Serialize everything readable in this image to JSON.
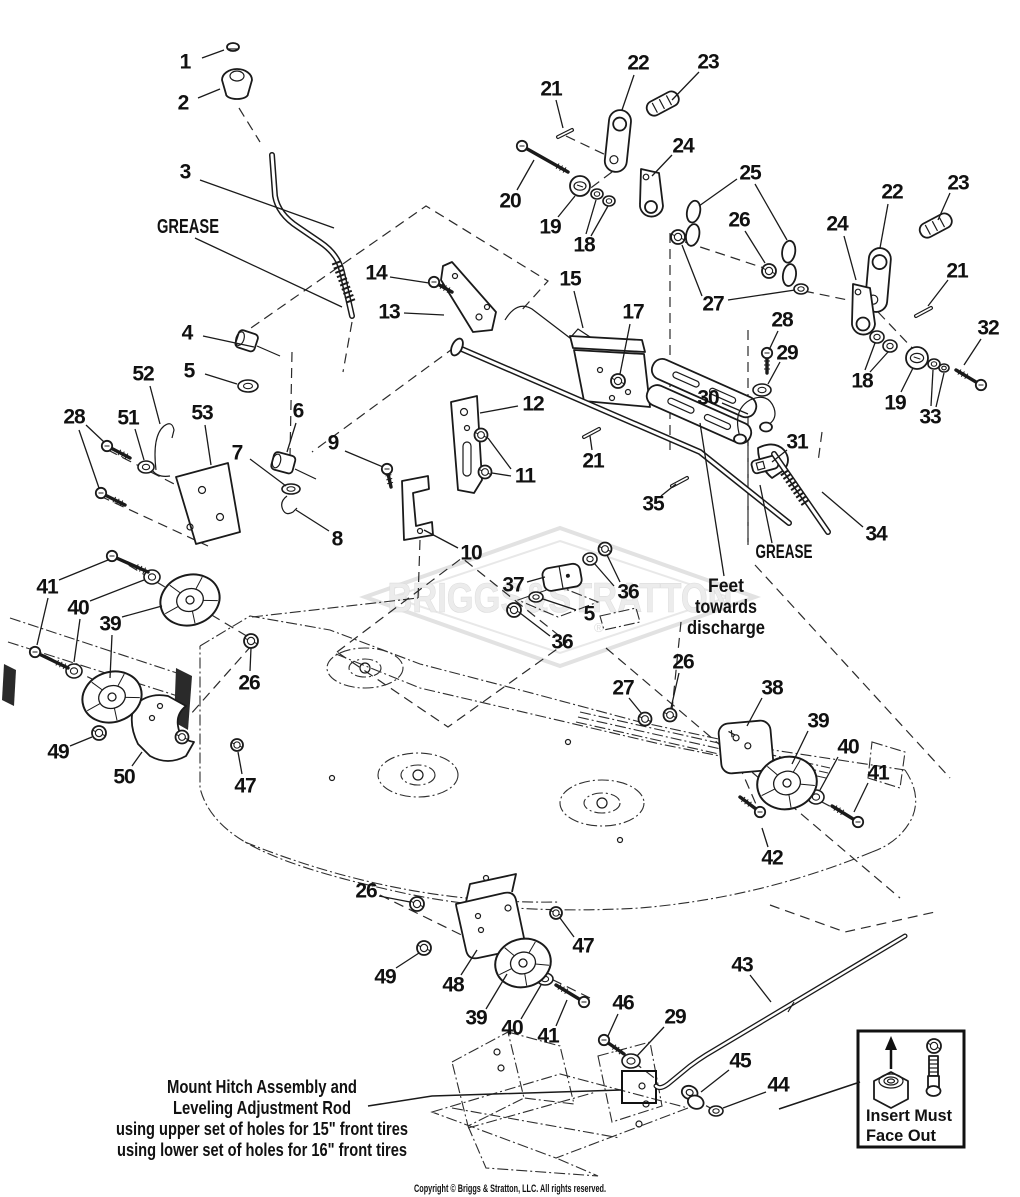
{
  "diagram": {
    "watermark": {
      "text": "BRIGGS&STRATTON",
      "registered_mark": "®"
    },
    "labels": {
      "grease_left": "GREASE",
      "grease_right": "GREASE",
      "feet_line1": "Feet",
      "feet_line2": "towards",
      "feet_line3": "discharge",
      "mount_line1": "Mount Hitch Assembly and",
      "mount_line2": "Leveling Adjustment Rod",
      "mount_line3": "using upper set of holes for 15\" front tires",
      "mount_line4": "using lower set of holes for 16\" front tires",
      "insert_line1": "Insert Must",
      "insert_line2": "Face Out"
    },
    "copyright": "Copyright © Briggs & Stratton, LLC. All rights reserved.",
    "callouts": [
      {
        "label": "1",
        "x": 185,
        "y": 62,
        "leaders": [
          [
            202,
            58,
            224,
            50
          ]
        ]
      },
      {
        "label": "2",
        "x": 183,
        "y": 103,
        "leaders": [
          [
            198,
            98,
            220,
            89
          ]
        ]
      },
      {
        "label": "3",
        "x": 185,
        "y": 172,
        "leaders": [
          [
            200,
            180,
            334,
            228
          ]
        ]
      },
      {
        "label": "4",
        "x": 187,
        "y": 333,
        "leaders": [
          [
            203,
            336,
            254,
            347
          ]
        ]
      },
      {
        "label": "5",
        "x": 189,
        "y": 371,
        "leaders": [
          [
            205,
            374,
            237,
            384
          ]
        ]
      },
      {
        "label": "52",
        "x": 143,
        "y": 374,
        "leaders": [
          [
            150,
            386,
            160,
            424
          ]
        ]
      },
      {
        "label": "51",
        "x": 128,
        "y": 418,
        "leaders": [
          [
            135,
            429,
            144,
            460
          ]
        ]
      },
      {
        "label": "53",
        "x": 202,
        "y": 413,
        "leaders": [
          [
            205,
            425,
            211,
            465
          ]
        ]
      },
      {
        "label": "28",
        "x": 74,
        "y": 417,
        "leaders": [
          [
            86,
            425,
            104,
            442
          ],
          [
            79,
            430,
            99,
            488
          ]
        ]
      },
      {
        "label": "6",
        "x": 298,
        "y": 411,
        "leaders": [
          [
            296,
            423,
            287,
            452
          ]
        ]
      },
      {
        "label": "7",
        "x": 237,
        "y": 453,
        "leaders": [
          [
            250,
            459,
            286,
            486
          ]
        ]
      },
      {
        "label": "8",
        "x": 337,
        "y": 539,
        "leaders": [
          [
            329,
            531,
            296,
            510
          ]
        ]
      },
      {
        "label": "9",
        "x": 333,
        "y": 443,
        "leaders": [
          [
            345,
            451,
            383,
            467
          ]
        ]
      },
      {
        "label": "10",
        "x": 471,
        "y": 553,
        "leaders": [
          [
            458,
            548,
            424,
            530
          ]
        ]
      },
      {
        "label": "14",
        "x": 376,
        "y": 273,
        "leaders": [
          [
            390,
            277,
            429,
            283
          ]
        ]
      },
      {
        "label": "13",
        "x": 389,
        "y": 312,
        "leaders": [
          [
            404,
            313,
            444,
            315
          ]
        ]
      },
      {
        "label": "15",
        "x": 570,
        "y": 279,
        "leaders": [
          [
            574,
            291,
            583,
            328
          ]
        ]
      },
      {
        "label": "17",
        "x": 633,
        "y": 312,
        "leaders": [
          [
            630,
            324,
            620,
            374
          ]
        ]
      },
      {
        "label": "12",
        "x": 533,
        "y": 404,
        "leaders": [
          [
            518,
            406,
            480,
            413
          ]
        ]
      },
      {
        "label": "11",
        "x": 525,
        "y": 476,
        "leaders": [
          [
            511,
            469,
            488,
            438
          ],
          [
            511,
            476,
            492,
            473
          ]
        ]
      },
      {
        "label": "21",
        "x": 593,
        "y": 461,
        "leaders": [
          [
            592,
            450,
            590,
            436
          ]
        ]
      },
      {
        "label": "35",
        "x": 653,
        "y": 504,
        "leaders": [
          [
            661,
            496,
            676,
            484
          ]
        ]
      },
      {
        "label": "20",
        "x": 510,
        "y": 201,
        "leaders": [
          [
            517,
            190,
            534,
            160
          ]
        ]
      },
      {
        "label": "19",
        "x": 550,
        "y": 227,
        "leaders": [
          [
            558,
            217,
            575,
            196
          ]
        ]
      },
      {
        "label": "18",
        "x": 584,
        "y": 245,
        "leaders": [
          [
            586,
            234,
            596,
            200
          ],
          [
            591,
            236,
            608,
            206
          ]
        ]
      },
      {
        "label": "22",
        "x": 638,
        "y": 63,
        "leaders": [
          [
            634,
            75,
            622,
            110
          ]
        ]
      },
      {
        "label": "23",
        "x": 708,
        "y": 62,
        "leaders": [
          [
            699,
            72,
            672,
            100
          ]
        ]
      },
      {
        "label": "21",
        "x": 551,
        "y": 89,
        "leaders": [
          [
            556,
            100,
            563,
            128
          ]
        ]
      },
      {
        "label": "24",
        "x": 683,
        "y": 146,
        "leaders": [
          [
            672,
            155,
            652,
            176
          ]
        ]
      },
      {
        "label": "25",
        "x": 750,
        "y": 173,
        "leaders": [
          [
            737,
            179,
            699,
            206
          ],
          [
            755,
            184,
            787,
            240
          ]
        ]
      },
      {
        "label": "26",
        "x": 739,
        "y": 220,
        "leaders": [
          [
            745,
            231,
            765,
            263
          ]
        ]
      },
      {
        "label": "27",
        "x": 713,
        "y": 304,
        "leaders": [
          [
            702,
            296,
            682,
            245
          ],
          [
            728,
            300,
            795,
            290
          ]
        ]
      },
      {
        "label": "28",
        "x": 782,
        "y": 320,
        "leaders": [
          [
            778,
            331,
            769,
            350
          ]
        ]
      },
      {
        "label": "29",
        "x": 787,
        "y": 353,
        "leaders": [
          [
            780,
            362,
            768,
            384
          ]
        ]
      },
      {
        "label": "30",
        "x": 708,
        "y": 398,
        "leaders": [
          [
            722,
            403,
            748,
            414
          ]
        ]
      },
      {
        "label": "31",
        "x": 797,
        "y": 442,
        "leaders": [
          [
            787,
            450,
            772,
            462
          ]
        ]
      },
      {
        "label": "22",
        "x": 892,
        "y": 192,
        "leaders": [
          [
            888,
            204,
            880,
            248
          ]
        ]
      },
      {
        "label": "23",
        "x": 958,
        "y": 183,
        "leaders": [
          [
            950,
            193,
            938,
            220
          ]
        ]
      },
      {
        "label": "24",
        "x": 837,
        "y": 224,
        "leaders": [
          [
            844,
            236,
            856,
            280
          ]
        ]
      },
      {
        "label": "21",
        "x": 957,
        "y": 271,
        "leaders": [
          [
            948,
            280,
            928,
            306
          ]
        ]
      },
      {
        "label": "18",
        "x": 862,
        "y": 381,
        "leaders": [
          [
            865,
            370,
            875,
            343
          ],
          [
            870,
            372,
            888,
            352
          ]
        ]
      },
      {
        "label": "19",
        "x": 895,
        "y": 403,
        "leaders": [
          [
            901,
            392,
            913,
            368
          ]
        ]
      },
      {
        "label": "33",
        "x": 930,
        "y": 417,
        "leaders": [
          [
            931,
            406,
            933,
            370
          ],
          [
            936,
            407,
            944,
            373
          ]
        ]
      },
      {
        "label": "32",
        "x": 988,
        "y": 328,
        "leaders": [
          [
            981,
            339,
            964,
            365
          ]
        ]
      },
      {
        "label": "34",
        "x": 876,
        "y": 534,
        "leaders": [
          [
            863,
            527,
            822,
            492
          ]
        ]
      },
      {
        "label": "37",
        "x": 513,
        "y": 585,
        "leaders": [
          [
            527,
            582,
            545,
            577
          ]
        ]
      },
      {
        "label": "36",
        "x": 628,
        "y": 592,
        "leaders": [
          [
            620,
            582,
            607,
            555
          ],
          [
            614,
            586,
            594,
            563
          ]
        ]
      },
      {
        "label": "5",
        "x": 589,
        "y": 614,
        "leaders": [
          [
            576,
            610,
            543,
            599
          ]
        ]
      },
      {
        "label": "36",
        "x": 562,
        "y": 642,
        "leaders": [
          [
            550,
            636,
            520,
            613
          ]
        ]
      },
      {
        "label": "26",
        "x": 249,
        "y": 683,
        "leaders": [
          [
            250,
            671,
            251,
            648
          ]
        ]
      },
      {
        "label": "47",
        "x": 245,
        "y": 786,
        "leaders": [
          [
            242,
            774,
            238,
            752
          ]
        ]
      },
      {
        "label": "50",
        "x": 124,
        "y": 777,
        "leaders": [
          [
            132,
            766,
            142,
            752
          ]
        ]
      },
      {
        "label": "49",
        "x": 58,
        "y": 752,
        "leaders": [
          [
            70,
            746,
            92,
            737
          ]
        ]
      },
      {
        "label": "39",
        "x": 110,
        "y": 624,
        "leaders": [
          [
            122,
            617,
            162,
            606
          ],
          [
            112,
            635,
            110,
            678
          ]
        ]
      },
      {
        "label": "40",
        "x": 78,
        "y": 608,
        "leaders": [
          [
            90,
            601,
            144,
            580
          ],
          [
            80,
            619,
            74,
            662
          ]
        ]
      },
      {
        "label": "41",
        "x": 47,
        "y": 587,
        "leaders": [
          [
            59,
            580,
            108,
            560
          ],
          [
            48,
            598,
            37,
            645
          ]
        ]
      },
      {
        "label": "27",
        "x": 623,
        "y": 688,
        "leaders": [
          [
            629,
            698,
            642,
            714
          ]
        ]
      },
      {
        "label": "26",
        "x": 683,
        "y": 662,
        "leaders": [
          [
            679,
            673,
            671,
            708
          ]
        ]
      },
      {
        "label": "38",
        "x": 772,
        "y": 688,
        "leaders": [
          [
            762,
            698,
            747,
            726
          ]
        ]
      },
      {
        "label": "39",
        "x": 818,
        "y": 721,
        "leaders": [
          [
            808,
            731,
            792,
            764
          ]
        ]
      },
      {
        "label": "40",
        "x": 848,
        "y": 747,
        "leaders": [
          [
            838,
            757,
            820,
            790
          ]
        ]
      },
      {
        "label": "41",
        "x": 878,
        "y": 773,
        "leaders": [
          [
            868,
            783,
            854,
            812
          ]
        ]
      },
      {
        "label": "42",
        "x": 772,
        "y": 858,
        "leaders": [
          [
            768,
            847,
            762,
            828
          ]
        ]
      },
      {
        "label": "26",
        "x": 366,
        "y": 891,
        "leaders": [
          [
            379,
            896,
            410,
            902
          ]
        ]
      },
      {
        "label": "49",
        "x": 385,
        "y": 977,
        "leaders": [
          [
            396,
            968,
            419,
            953
          ]
        ]
      },
      {
        "label": "48",
        "x": 453,
        "y": 985,
        "leaders": [
          [
            461,
            975,
            477,
            950
          ]
        ]
      },
      {
        "label": "39",
        "x": 476,
        "y": 1018,
        "leaders": [
          [
            486,
            1009,
            507,
            974
          ]
        ]
      },
      {
        "label": "40",
        "x": 512,
        "y": 1028,
        "leaders": [
          [
            521,
            1019,
            541,
            985
          ]
        ]
      },
      {
        "label": "41",
        "x": 548,
        "y": 1036,
        "leaders": [
          [
            556,
            1026,
            567,
            1000
          ]
        ]
      },
      {
        "label": "47",
        "x": 583,
        "y": 946,
        "leaders": [
          [
            574,
            937,
            560,
            918
          ]
        ]
      },
      {
        "label": "46",
        "x": 623,
        "y": 1003,
        "leaders": [
          [
            618,
            1014,
            608,
            1036
          ]
        ]
      },
      {
        "label": "29",
        "x": 675,
        "y": 1017,
        "leaders": [
          [
            664,
            1027,
            637,
            1056
          ]
        ]
      },
      {
        "label": "45",
        "x": 740,
        "y": 1061,
        "leaders": [
          [
            729,
            1070,
            701,
            1092
          ]
        ]
      },
      {
        "label": "44",
        "x": 778,
        "y": 1085,
        "leaders": [
          [
            766,
            1092,
            723,
            1108
          ]
        ]
      },
      {
        "label": "43",
        "x": 742,
        "y": 965,
        "leaders": [
          [
            750,
            975,
            771,
            1002
          ]
        ]
      }
    ]
  }
}
